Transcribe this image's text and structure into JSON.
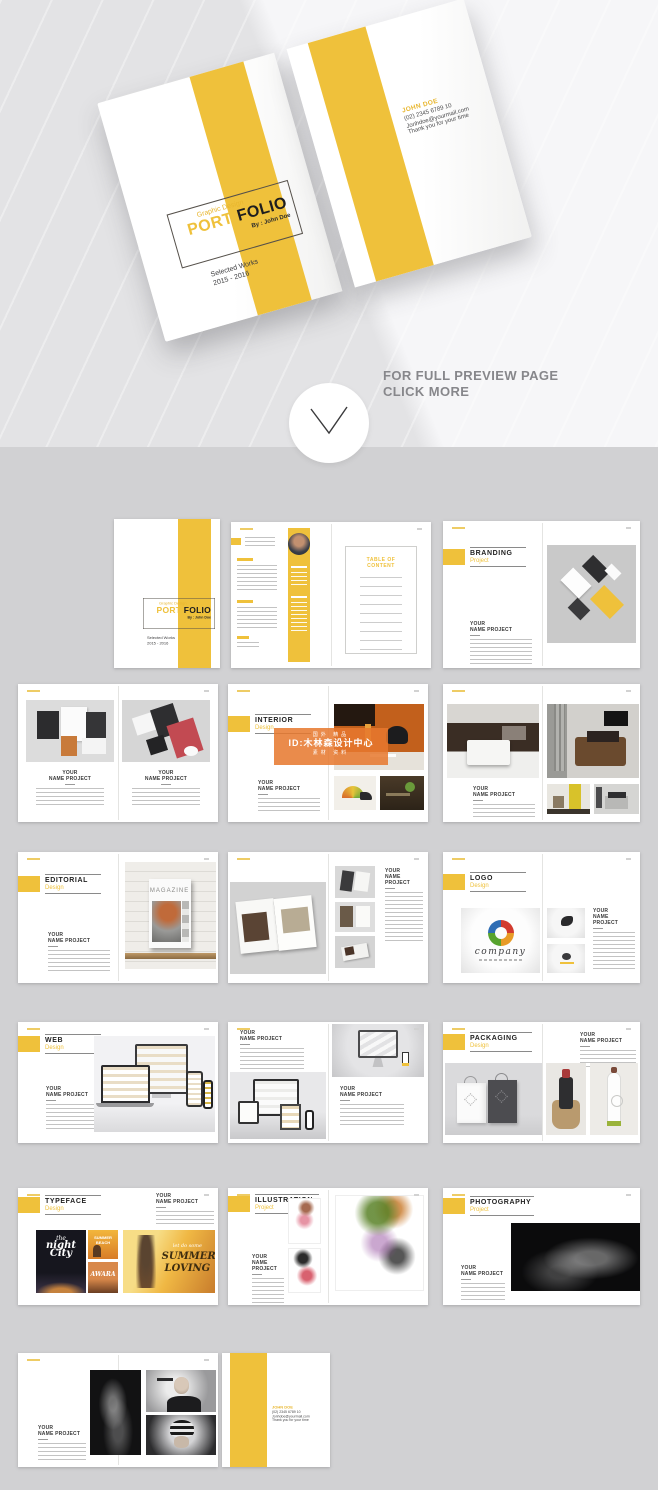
{
  "hero": {
    "preview": {
      "line1": "FOR FULL PREVIEW PAGE",
      "line2": "CLICK MORE"
    },
    "cover": {
      "kicker": "Graphic Design",
      "title_a": "PORT",
      "title_b": "FOLIO",
      "byline": "By : John Doe",
      "works_line1": "Selected Works",
      "works_line2": "2015 - 2016"
    },
    "contact": {
      "name": "JOHN DOE",
      "phone": "(02) 2345 6789 10",
      "email": "Jonhdoe@yourmail.com",
      "thanks": "Thank you for your time"
    }
  },
  "labels": {
    "your": "YOUR",
    "name_project": "NAME PROJECT"
  },
  "toc_title": "TABLE OF CONTENT",
  "sections": {
    "branding": {
      "title": "BRANDING",
      "subtitle": "Project"
    },
    "interior": {
      "title": "INTERIOR",
      "subtitle": "Design"
    },
    "editorial": {
      "title": "EDITORIAL",
      "subtitle": "Design"
    },
    "logo": {
      "title": "LOGO",
      "subtitle": "Design"
    },
    "web": {
      "title": "WEB",
      "subtitle": "Design"
    },
    "packaging": {
      "title": "PACKAGING",
      "subtitle": "Design"
    },
    "typeface": {
      "title": "TYPEFACE",
      "subtitle": "Design"
    },
    "illustration": {
      "title": "ILLUSTRATION",
      "subtitle": "Project"
    },
    "photography": {
      "title": "PHOTOGRAPHY",
      "subtitle": "Project"
    }
  },
  "watermark": {
    "top": "国外 精品",
    "mid": "ID:木林森设计中心",
    "bottom": "素材 资料"
  },
  "art": {
    "magazine": "MAGAZINE",
    "company": "company",
    "night_a": "the",
    "night_b": "night",
    "night_c": "City",
    "beach_a": "SUMMER",
    "beach_b": "BEACH",
    "awara": "AWARA",
    "summer_kicker": "let do some",
    "summer_a": "SUMMER",
    "summer_b": "LOVING"
  },
  "colors": {
    "accent": "#EFC13B",
    "background": "#D1D1D3",
    "watermark_orange": "#E6782D"
  }
}
